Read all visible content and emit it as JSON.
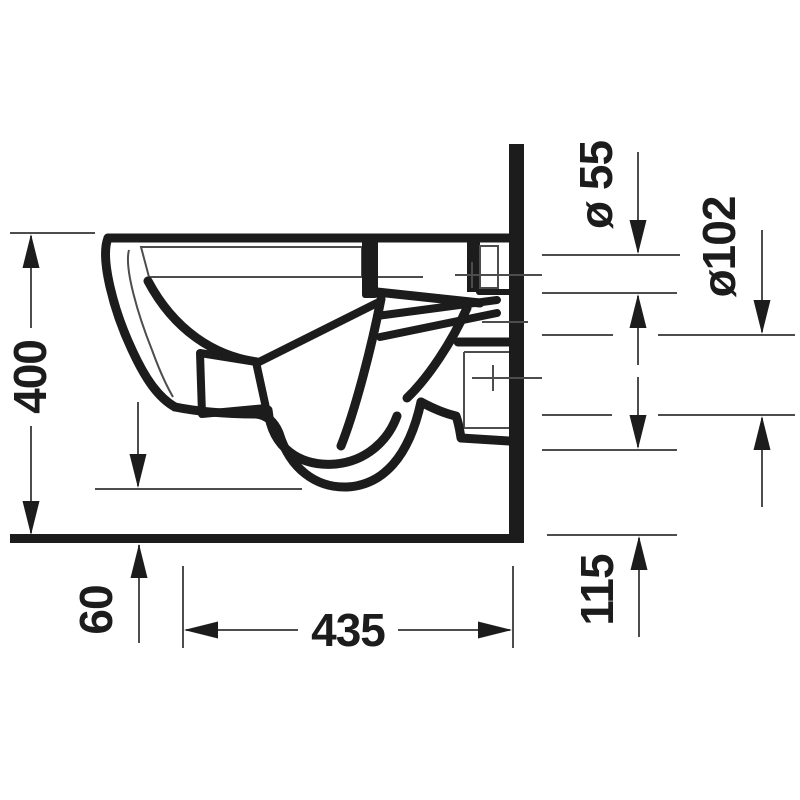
{
  "page": {
    "background": "#ffffff",
    "description": "Technical side-elevation drawing of a wall-hung toilet with installation dimensions"
  },
  "drawing": {
    "colors": {
      "outline": "#1c1c1c",
      "thin_line": "#4d4d4d",
      "text": "#1c1c1c",
      "background": "#ffffff"
    },
    "labels": {
      "overall_height": "400",
      "floor_clearance": "60",
      "depth": "435",
      "outlet_height": "115",
      "flush_inlet_diameter": "ø 55",
      "outlet_diameter": "ø102"
    }
  }
}
